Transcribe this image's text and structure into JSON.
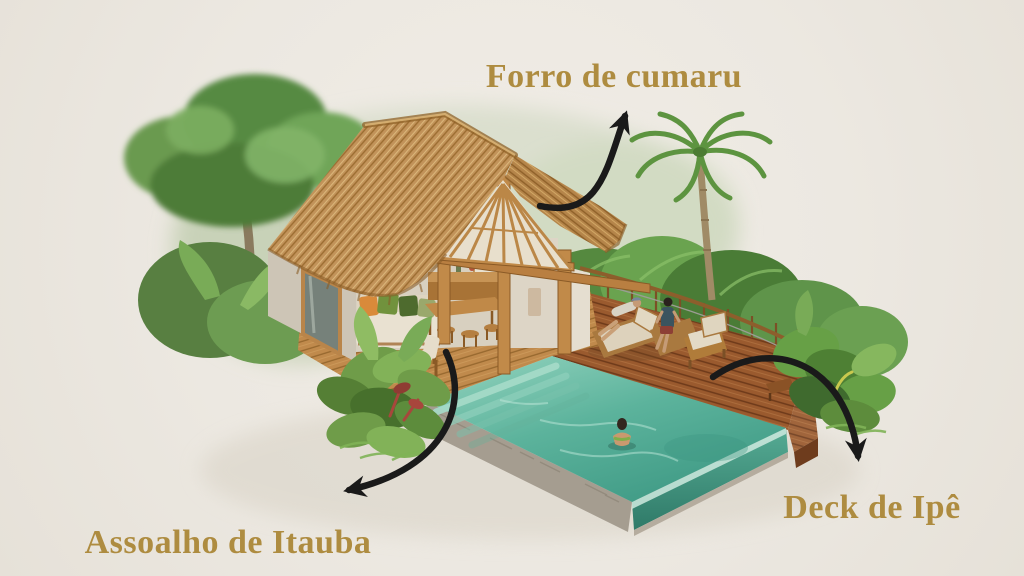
{
  "page": {
    "background_color": "#ece8e1",
    "content_type": "annotated 3D render of a tropical bungalow with infinity pool",
    "language": "pt"
  },
  "label_style": {
    "color": "#ae8c40",
    "font_size_px": 34,
    "style": "serif gold lettering"
  },
  "annotations": [
    {
      "label": "Forro de cumaru",
      "position": "top-center",
      "arrow_target": "thatched-roof-ceiling"
    },
    {
      "label": "Assoalho de Itauba",
      "position": "bottom-left",
      "arrow_target": "interior-wood-floor"
    },
    {
      "label": "Deck de Ipê",
      "position": "bottom-right",
      "arrow_target": "pool-deck"
    }
  ],
  "scene": {
    "description": "Isometric render of a small thatched-roof bungalow with open living area (sofa with pillows, bar counter, dining table and stools), golden hardwood floor, reddish hardwood pool deck with cable railing, two people on sun loungers, an armchair, an infinity pool with entry steps and one swimmer, surrounded by lush tropical vegetation, a large tree and a palm tree",
    "figures": [
      "man with cap reclining on wooden lounger",
      "woman seated on lounger",
      "woman standing in the pool"
    ],
    "palette": {
      "thatch": "#c2935a",
      "wood_structure": "#c18a49",
      "itauba_floor": "#c08a4c",
      "ipe_deck": "#9a5a2e",
      "pool_water": "#57b09a",
      "stone_edge": "#a59d90",
      "foliage_green": "#5f944a",
      "arrow_black": "#1a1a1a",
      "label_gold": "#ae8c40"
    }
  }
}
